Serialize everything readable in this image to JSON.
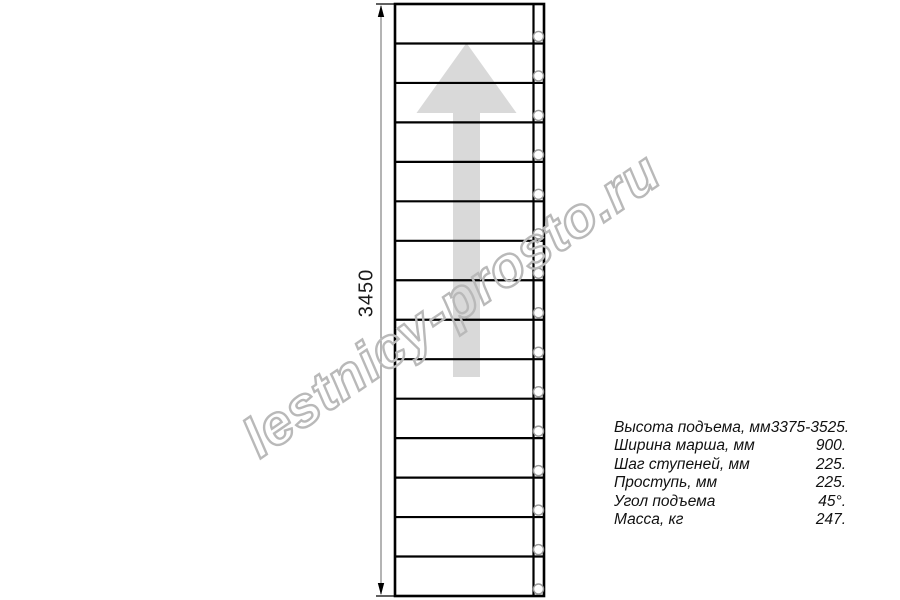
{
  "dimension": {
    "label": "3450"
  },
  "watermark": {
    "text": "lestnicy-prosto.ru",
    "color": "#b9b9b9"
  },
  "specs": {
    "rows": [
      {
        "label": "Высота подъема, мм",
        "value": "3375-3525."
      },
      {
        "label": "Ширина марша, мм",
        "value": "900."
      },
      {
        "label": "Шаг ступеней, мм",
        "value": "225."
      },
      {
        "label": "Проступь, мм",
        "value": "225."
      },
      {
        "label": "Угол подъема",
        "value": "45°."
      },
      {
        "label": "Масса, кг",
        "value": "247."
      }
    ]
  },
  "drawing": {
    "line_color": "#000000",
    "arrow_color": "#d9d9d9",
    "dim_line_color": "#8c8c8c",
    "circle_color": "#9a9a9a",
    "tread_count": 15,
    "plan": {
      "left": 395,
      "top": 4,
      "right": 544,
      "bottom": 596,
      "stringer_x": 533.5
    },
    "bolts": {
      "cx": 538.5,
      "r": 5,
      "offset_above_line": 7
    },
    "up_arrow": {
      "x": 466.5,
      "tip_y": 43,
      "base_y": 113,
      "head_half": 50,
      "tail_half": 13.5,
      "tail_bottom": 377
    },
    "dim_line": {
      "x": 381,
      "ext_left": 376
    }
  }
}
